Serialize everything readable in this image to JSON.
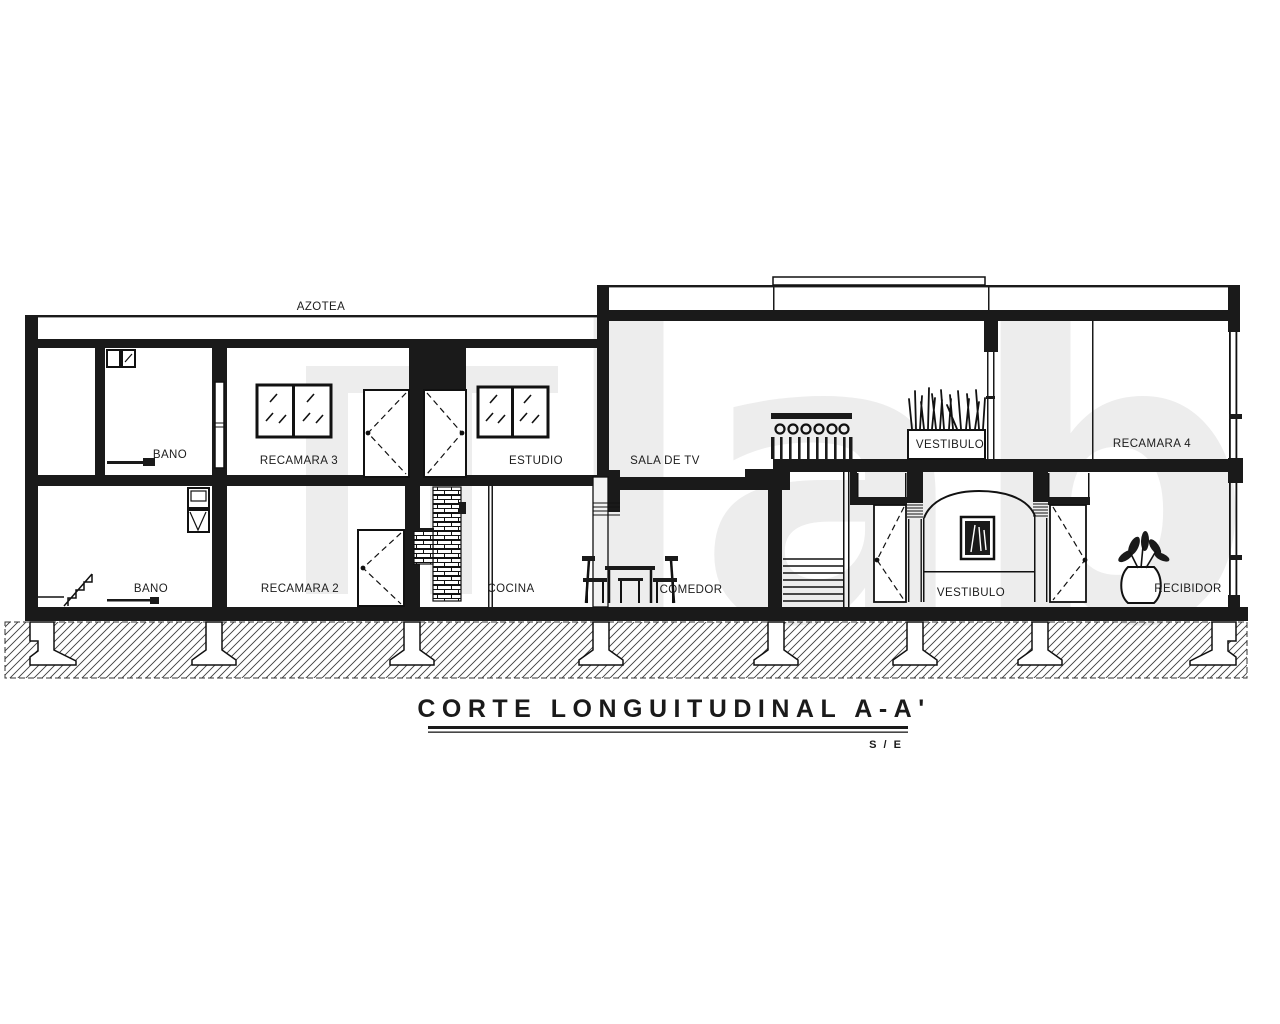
{
  "document": {
    "title": "CORTE LONGUITUDINAL A-A'",
    "scale_note": "S / E",
    "watermark": "lab"
  },
  "labels": {
    "azotea": "AZOTEA",
    "bano_upper": "BANO",
    "recamara_3": "RECAMARA 3",
    "estudio": "ESTUDIO",
    "sala_de_tv": "SALA DE TV",
    "vestibulo_upper": "VESTIBULO",
    "recamara_4": "RECAMARA 4",
    "bano_lower": "BANO",
    "recamara_2": "RECAMARA 2",
    "cocina": "COCINA",
    "comedor": "COMEDOR",
    "vestibulo_lower": "VESTIBULO",
    "recibidor": "RECIBIDOR"
  },
  "colors": {
    "ink": "#1a1a1a",
    "paper": "#ffffff",
    "watermark": "#ececec"
  }
}
